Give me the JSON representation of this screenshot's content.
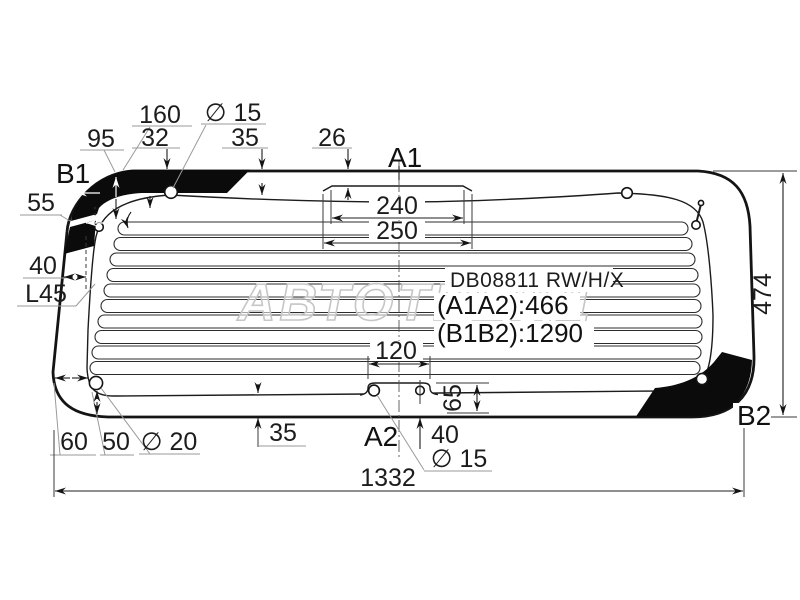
{
  "drawing": {
    "part_code": "DB08811 RW/H/X",
    "spec_a1a2": "(A1A2):466",
    "spec_b1b2": "(B1B2):1290",
    "watermark": "АВТОТРЕЙД",
    "points": {
      "a1": "A1",
      "a2": "A2",
      "b1": "B1",
      "b2": "B2"
    },
    "dims": {
      "t95": "95",
      "t160": "160",
      "t32": "32",
      "t_d15": "∅ 15",
      "t35": "35",
      "t26": "26",
      "t240": "240",
      "t250": "250",
      "l55": "55",
      "l40": "40",
      "l45": "L45",
      "r474": "474",
      "b60": "60",
      "b50": "50",
      "b_d20": "∅ 20",
      "b35": "35",
      "b40": "40",
      "b_d15": "∅ 15",
      "b120": "120",
      "b65": "65",
      "b1332": "1332"
    }
  }
}
